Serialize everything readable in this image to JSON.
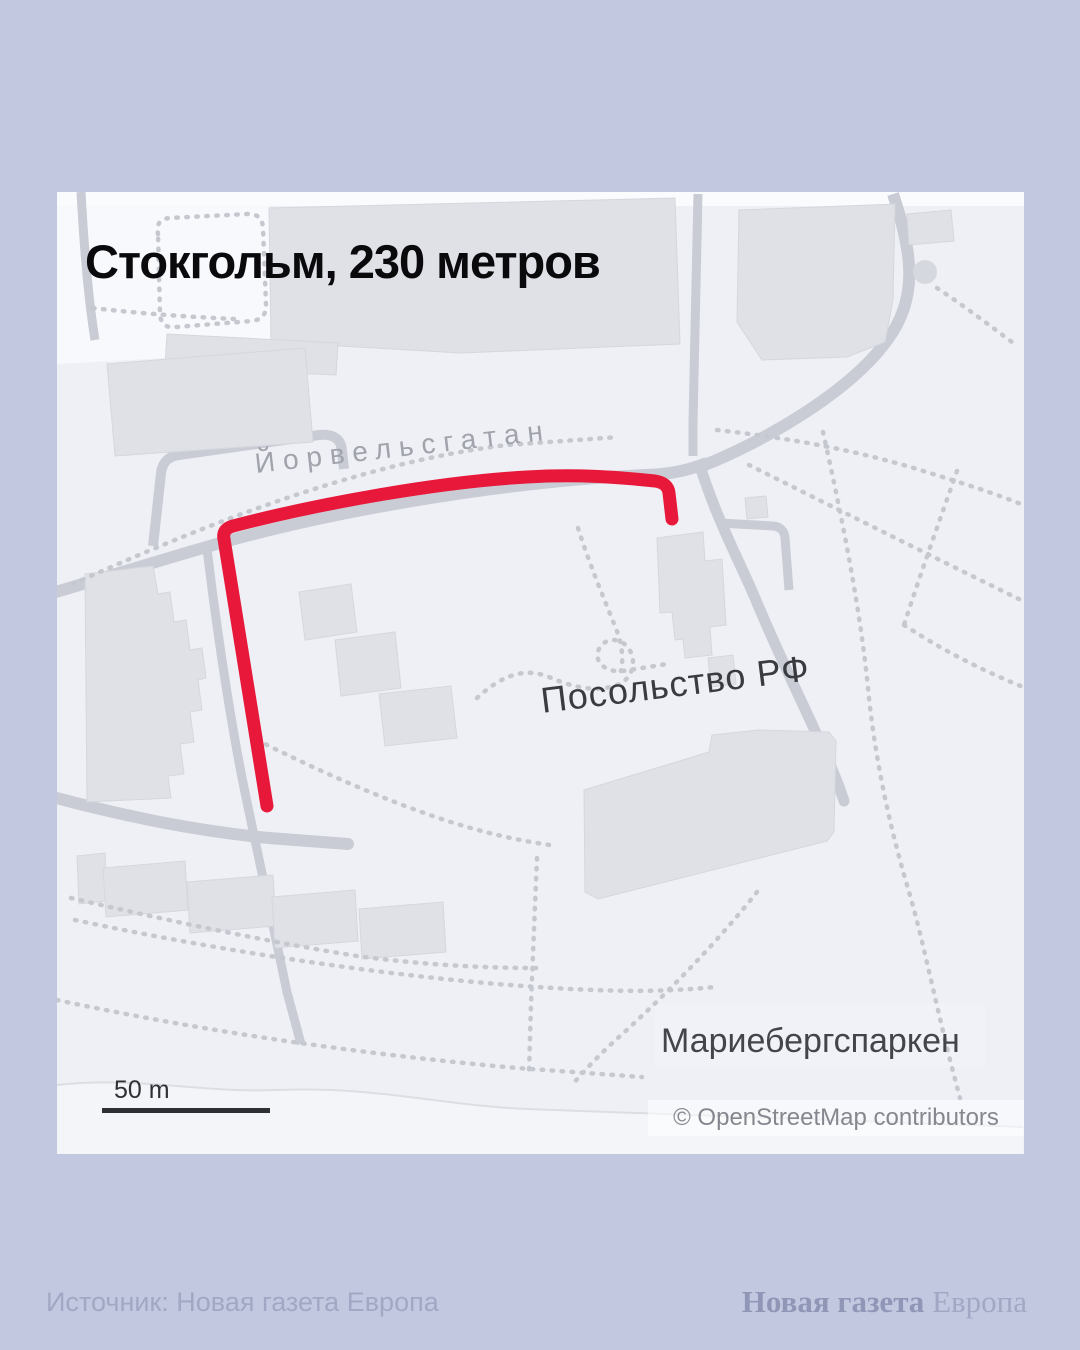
{
  "title": "Стокгольм, 230 метров",
  "map": {
    "street_label": "Йорвельсгатан",
    "embassy_label": "Посольство РФ",
    "park_label": "Мариебергспаркен",
    "scale_label": "50 m",
    "attribution": "© OpenStreetMap contributors",
    "route_color": "#e8183a"
  },
  "colors": {
    "page_background": "#c3c8e1",
    "map_background": "#eef0f5",
    "route": "#e8183a"
  },
  "footer": {
    "source": "Источник: Новая газета Европа",
    "logo_bold": "Новая газета",
    "logo_light": "Европа"
  }
}
